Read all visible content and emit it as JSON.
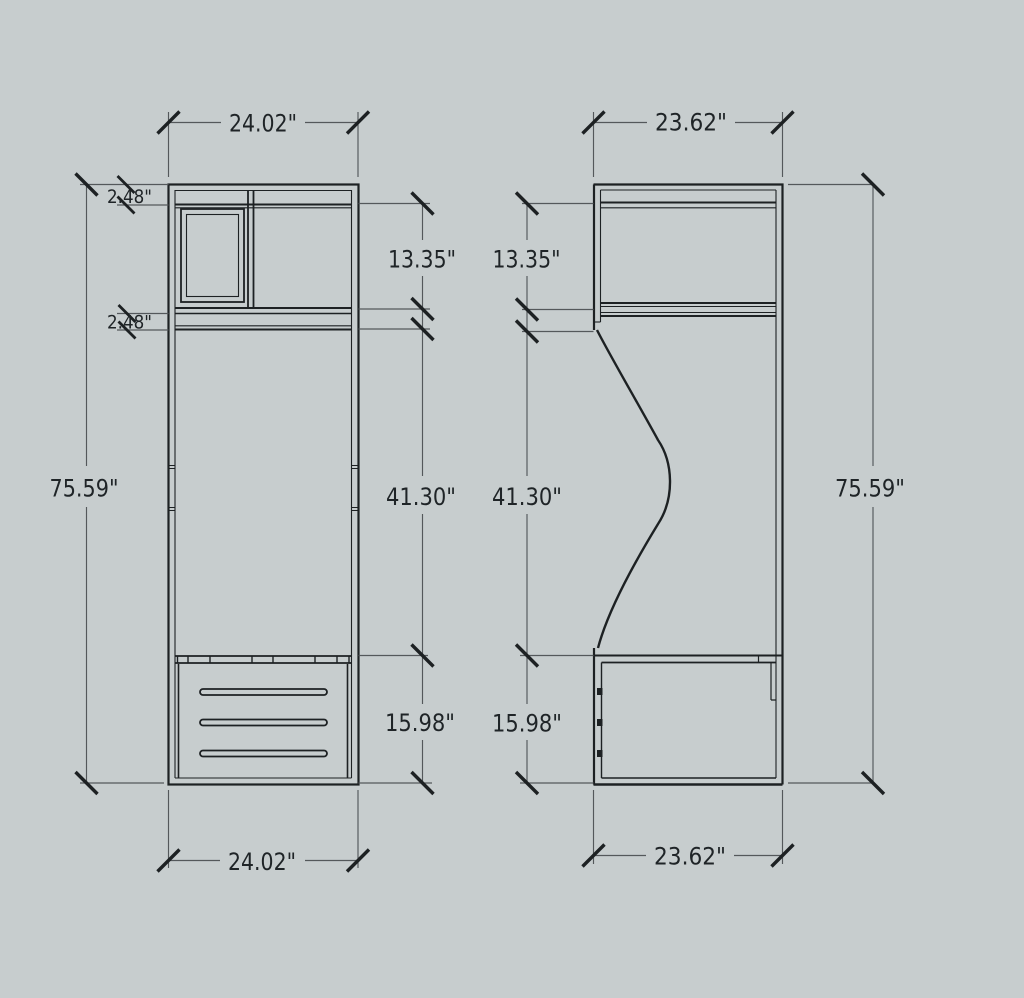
{
  "colors": {
    "bg": "#c7cdce",
    "line": "#1d2123",
    "dim": "#54585b",
    "tick": "#1d2123",
    "text": "#1f2427"
  },
  "views": {
    "front": {
      "dims": {
        "top_width": "24.02\"",
        "bottom_width": "24.02\"",
        "height": "75.59\"",
        "top_rail": "2.48\"",
        "shelf_gap": "2.48\"",
        "upper_section": "13.35\"",
        "middle_section": "41.30\"",
        "drawer_section": "15.98\""
      }
    },
    "side": {
      "dims": {
        "top_width": "23.62\"",
        "bottom_width": "23.62\"",
        "height": "75.59\"",
        "upper_section": "13.35\"",
        "middle_section": "41.30\"",
        "drawer_section": "15.98\""
      }
    }
  }
}
